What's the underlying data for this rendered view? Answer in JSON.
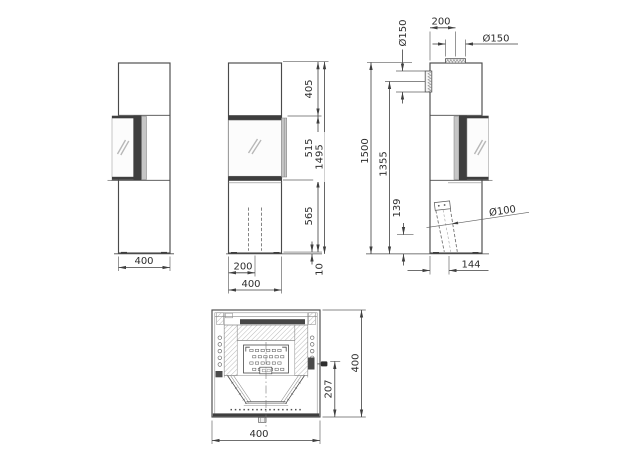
{
  "views": {
    "side_view_a": {
      "width": "400"
    },
    "front_view": {
      "top_section": "405",
      "door_section": "515",
      "base_section": "565",
      "total_height": "1495",
      "pipe_center_offset": "200",
      "width": "400",
      "floor_gap": "10"
    },
    "side_view_b": {
      "top_flue_offset": "200",
      "top_flue_diameter": "Ø150",
      "rear_flue_diameter": "Ø150",
      "total_height": "1500",
      "rear_flue_height": "1355",
      "air_inlet_height": "139",
      "air_inlet_diameter": "Ø100",
      "air_inlet_offset": "144"
    },
    "top_view": {
      "width": "400",
      "depth": "400",
      "handle_depth": "207"
    }
  },
  "colors": {
    "line": "#4a4a4a",
    "dark_fill": "#3e3e3e",
    "panel_gray": "#c6c6c6",
    "hatch": "#8f8f8f",
    "text": "#2d2d2d",
    "background": "#ffffff"
  }
}
